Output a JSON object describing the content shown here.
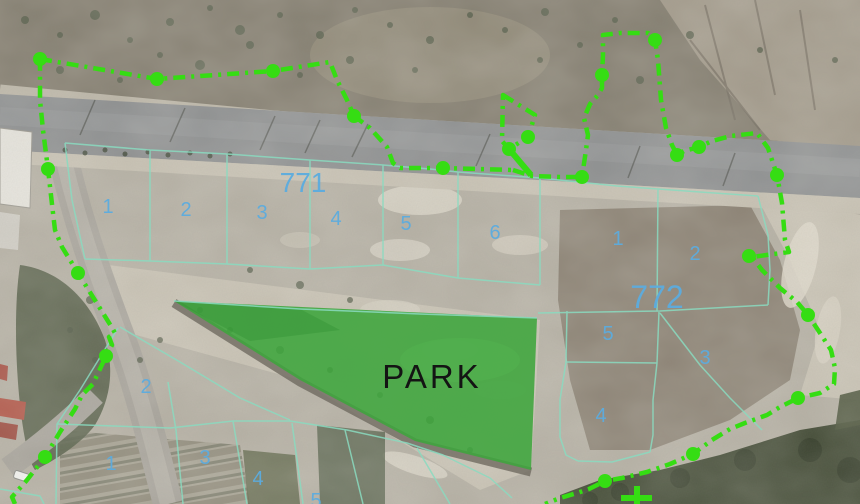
{
  "map": {
    "park": {
      "label": "PARK"
    },
    "blocks": {
      "b771": {
        "label": "771",
        "parcels": [
          "1",
          "2",
          "3",
          "4",
          "5",
          "6"
        ]
      },
      "b772": {
        "label": "772",
        "parcels": [
          "1",
          "2",
          "5",
          "3",
          "4"
        ]
      },
      "bottom": {
        "parcels": [
          "2",
          "1",
          "3",
          "4",
          "5"
        ]
      }
    },
    "colors": {
      "boundary": "#35dd13",
      "parcel_line": "#8adbc0",
      "parcel_number": "#5cacdf",
      "block_label": "#5cacdf",
      "park_fill": "#3da53c",
      "park_text": "#141414"
    }
  }
}
